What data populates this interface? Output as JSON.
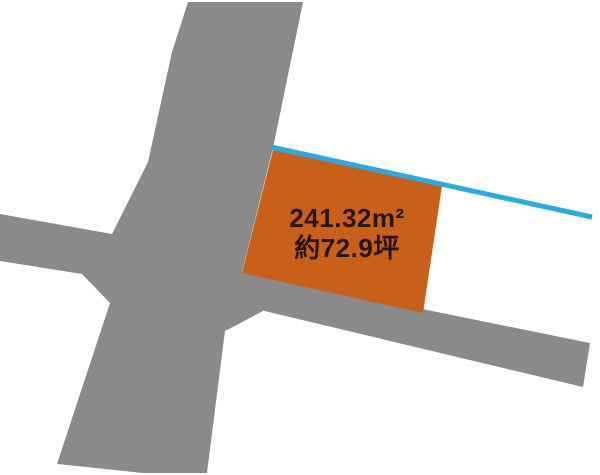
{
  "figure": {
    "kind": "land-plot-map",
    "plot": {
      "area_label": "241.32m²",
      "area_tsubo_label": "約72.9坪"
    },
    "colors": {
      "background": "#ffffff",
      "road": "#8a8a8a",
      "plot": "#c8601a",
      "water_line": "#29abe2",
      "label_text": "#231815"
    }
  }
}
